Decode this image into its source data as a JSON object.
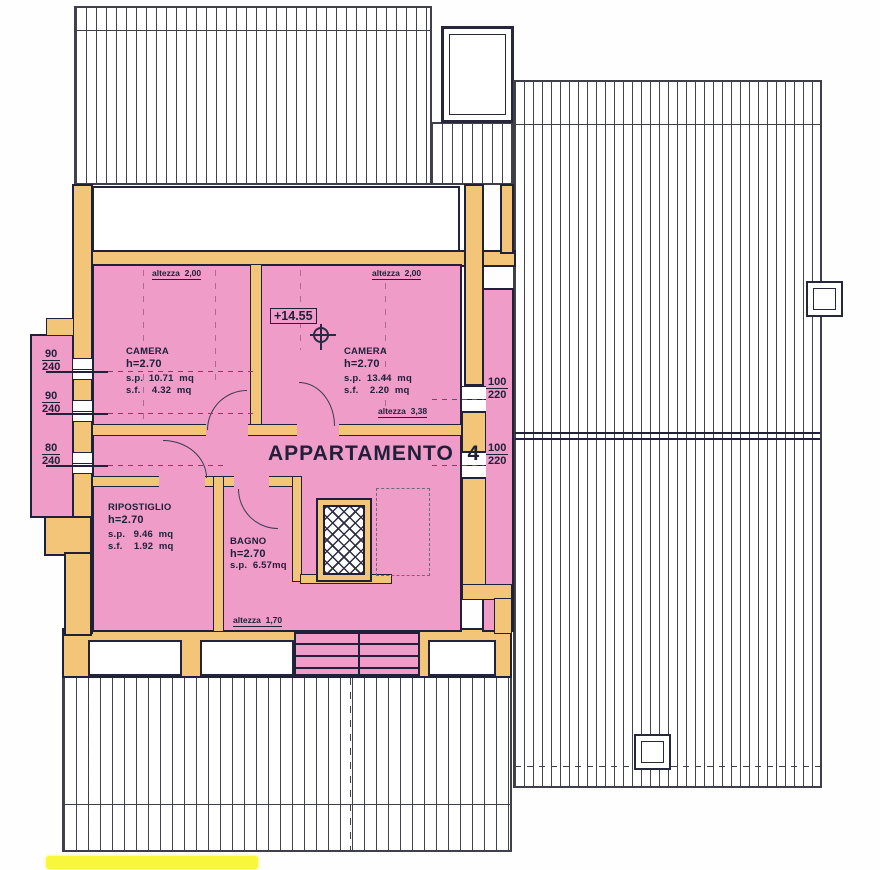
{
  "title": "APPARTAMENTO  4",
  "quota": "+14.55",
  "height_labels": {
    "top_left": "altezza  2,00",
    "top_right": "altezza  2,00",
    "mid": "altezza  3,38",
    "bottom": "altezza  1,70"
  },
  "rooms": {
    "camera1": {
      "name": "CAMERA",
      "h": "h=2.70",
      "sp": "s.p.  10.71  mq",
      "sf": "s.f.    4.32  mq"
    },
    "camera2": {
      "name": "CAMERA",
      "h": "h=2.70",
      "sp": "s.p.  13.44  mq",
      "sf": "s.f.    2.20  mq"
    },
    "ripostiglio": {
      "name": "RIPOSTIGLIO",
      "h": "h=2.70",
      "sp": "s.p.   9.46  mq",
      "sf": "s.f.    1.92  mq"
    },
    "bagno": {
      "name": "BAGNO",
      "h": "h=2.70",
      "sp": "s.p.  6.57mq"
    }
  },
  "dimensions": {
    "left": [
      {
        "num": "90",
        "den": "240"
      },
      {
        "num": "90",
        "den": "240"
      },
      {
        "num": "80",
        "den": "240"
      }
    ],
    "right": [
      {
        "num": "100",
        "den": "220"
      },
      {
        "num": "100",
        "den": "220"
      }
    ]
  },
  "colors": {
    "room_pink": "#f09cc8",
    "wall_orange": "#f3c579",
    "ink": "#20203a",
    "roof_line": "#43434e",
    "highlight_yellow": "#f8f73c"
  }
}
